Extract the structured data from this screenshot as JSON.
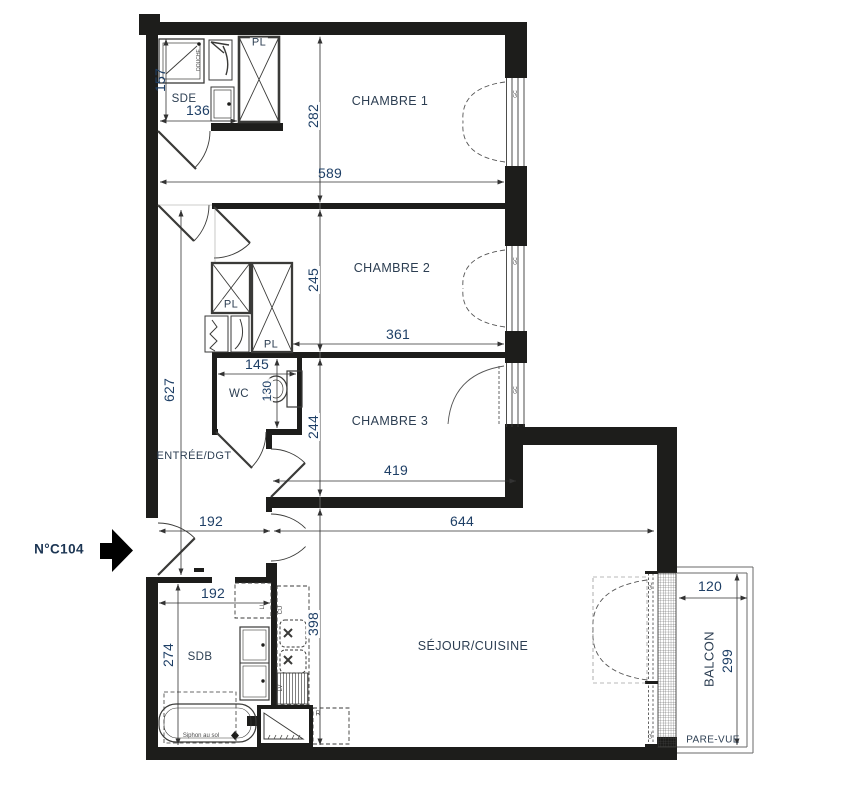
{
  "unit": {
    "label": "N°C104"
  },
  "rooms": {
    "chambre1": {
      "label": "CHAMBRE 1",
      "width_cm": "589",
      "depth_cm": "282"
    },
    "chambre2": {
      "label": "CHAMBRE 2",
      "width_cm": "361",
      "depth_cm": "245"
    },
    "chambre3": {
      "label": "CHAMBRE 3",
      "width_cm": "419",
      "depth_cm": "244"
    },
    "sejour_cuisine": {
      "label": "SÉJOUR/CUISINE",
      "width_cm": "644",
      "depth_cm": "398"
    },
    "sde": {
      "label": "SDE",
      "width_cm": "136",
      "depth_cm": "157"
    },
    "wc": {
      "label": "WC",
      "width_cm": "145",
      "depth_cm": "130"
    },
    "sdb": {
      "label": "SDB",
      "width_cm": "192",
      "depth_cm": "274"
    },
    "entree": {
      "label": "ENTRÉE/DGT",
      "width_cm": "192",
      "depth_cm": "627"
    },
    "balcon": {
      "label": "BALCON",
      "width_cm": "120",
      "depth_cm": "299",
      "screen_label": "PARE-VUE"
    }
  },
  "fixtures": {
    "closet": "PL",
    "washing_machine": "LL",
    "kitchen_unit": "CU",
    "dishwasher": "LV",
    "fridge": "R",
    "guardrail": "GC",
    "shower": "DOUCHE",
    "floor_drain": "Siphon au sol"
  }
}
